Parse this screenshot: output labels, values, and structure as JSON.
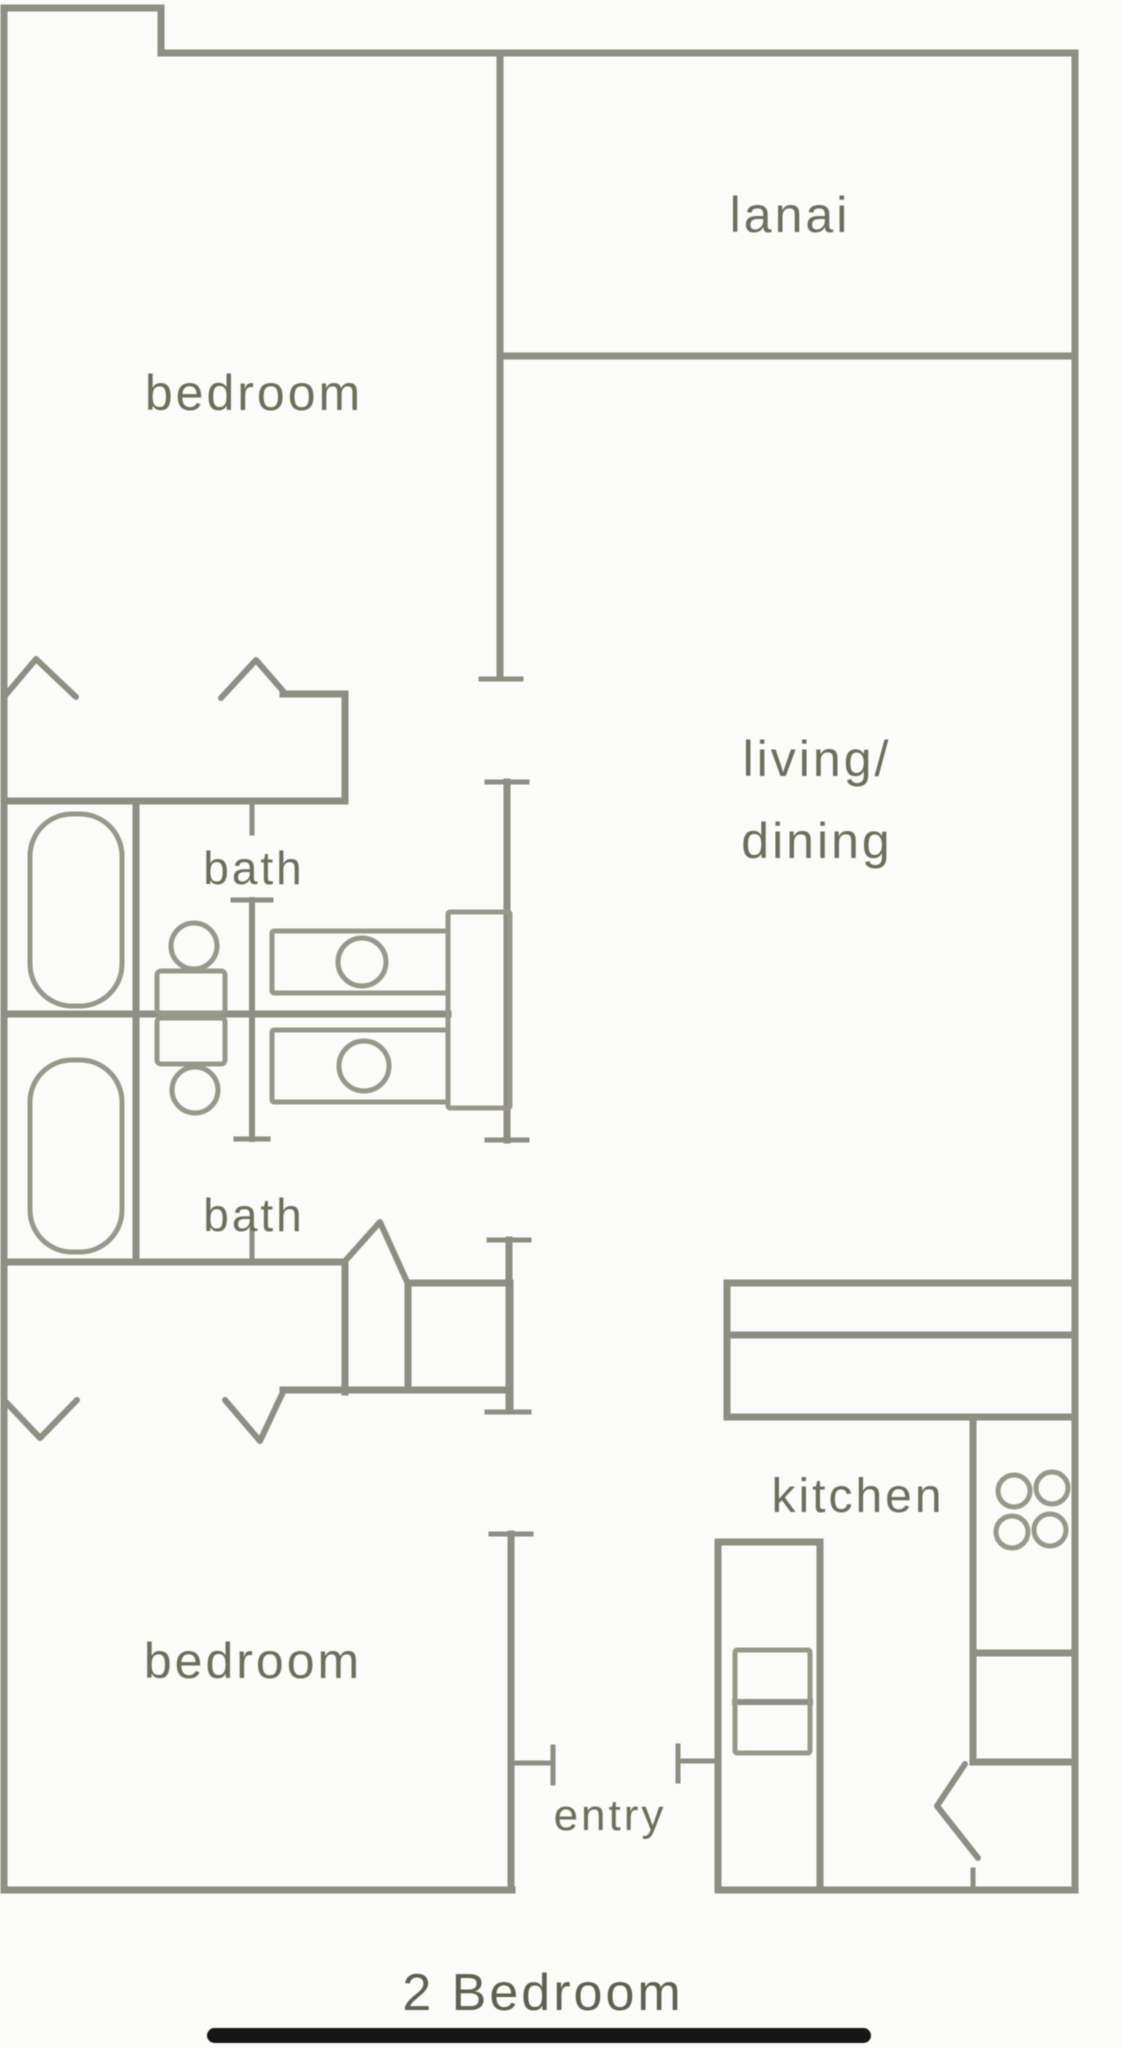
{
  "title": "2 Bedroom",
  "floorplan": {
    "canvas": {
      "width": 1122,
      "height": 2048
    },
    "colors": {
      "background": "#fbfbf9",
      "wall": "#8e8e82",
      "fixture": "#98988a",
      "label": "#6e6e5b",
      "title": "#60604f",
      "underline": "#161616"
    },
    "room_labels": [
      {
        "name": "label-lanai",
        "lines": [
          "lanai"
        ],
        "x": 790,
        "y": 232,
        "fontSize": 50
      },
      {
        "name": "label-bedroom-1",
        "lines": [
          "bedroom"
        ],
        "x": 254,
        "y": 410,
        "fontSize": 50
      },
      {
        "name": "label-living-dining",
        "lines": [
          "living/",
          "dining"
        ],
        "x": 817,
        "y": 776,
        "fontSize": 50,
        "lineHeight": 82
      },
      {
        "name": "label-bath-1",
        "lines": [
          "bath"
        ],
        "x": 254,
        "y": 884,
        "fontSize": 46
      },
      {
        "name": "label-bath-2",
        "lines": [
          "bath"
        ],
        "x": 254,
        "y": 1231,
        "fontSize": 46
      },
      {
        "name": "label-kitchen",
        "lines": [
          "kitchen"
        ],
        "x": 858,
        "y": 1512,
        "fontSize": 48
      },
      {
        "name": "label-entry",
        "lines": [
          "entry"
        ],
        "x": 610,
        "y": 1830,
        "fontSize": 44
      },
      {
        "name": "label-bedroom-2",
        "lines": [
          "bedroom"
        ],
        "x": 253,
        "y": 1678,
        "fontSize": 50
      }
    ],
    "plan_title": {
      "name": "plan-title",
      "text": "2 Bedroom",
      "x": 543,
      "y": 2010,
      "fontSize": 52
    },
    "title_underline": {
      "name": "title-underline-bar",
      "x": 207,
      "y": 2028,
      "w": 664,
      "h": 15
    },
    "walls": [
      {
        "name": "outer-top-left-upper",
        "x1": 4,
        "y1": 8,
        "x2": 161,
        "y2": 8
      },
      {
        "name": "outer-top-step",
        "x1": 161,
        "y1": 8,
        "x2": 161,
        "y2": 53
      },
      {
        "name": "outer-top-main",
        "x1": 161,
        "y1": 53,
        "x2": 1075,
        "y2": 53
      },
      {
        "name": "outer-right",
        "x1": 1075,
        "y1": 53,
        "x2": 1075,
        "y2": 1890
      },
      {
        "name": "outer-left",
        "x1": 4,
        "y1": 8,
        "x2": 4,
        "y2": 1890
      },
      {
        "name": "outer-bottom-left",
        "x1": 4,
        "y1": 1890,
        "x2": 512,
        "y2": 1890
      },
      {
        "name": "outer-bottom-right",
        "x1": 718,
        "y1": 1890,
        "x2": 1075,
        "y2": 1890
      },
      {
        "name": "bedroom1-living-divider",
        "x1": 500,
        "y1": 53,
        "x2": 500,
        "y2": 678
      },
      {
        "name": "divider-end-cap",
        "x1": 481,
        "y1": 679,
        "x2": 521,
        "y2": 679,
        "w": 5
      },
      {
        "name": "lanai-bottom-wall",
        "x1": 500,
        "y1": 356,
        "x2": 1075,
        "y2": 356
      },
      {
        "name": "hall-wall-cap-top",
        "x1": 487,
        "y1": 782,
        "x2": 527,
        "y2": 782,
        "w": 5
      },
      {
        "name": "hall-wall-upper",
        "x1": 507,
        "y1": 782,
        "x2": 507,
        "y2": 1140
      },
      {
        "name": "hall-wall-cap-mid",
        "x1": 487,
        "y1": 1140,
        "x2": 527,
        "y2": 1140,
        "w": 5
      },
      {
        "name": "hall-wall-cap-mid2",
        "x1": 489,
        "y1": 1240,
        "x2": 529,
        "y2": 1240,
        "w": 5
      },
      {
        "name": "hall-wall-lower",
        "x1": 509,
        "y1": 1240,
        "x2": 509,
        "y2": 1410
      },
      {
        "name": "hall-wall-cap-low",
        "x1": 487,
        "y1": 1412,
        "x2": 529,
        "y2": 1412,
        "w": 5
      },
      {
        "name": "bedroom2-door-cap",
        "x1": 491,
        "y1": 1534,
        "x2": 531,
        "y2": 1534,
        "w": 5
      },
      {
        "name": "entry-left-wall",
        "x1": 511,
        "y1": 1534,
        "x2": 511,
        "y2": 1890
      },
      {
        "name": "bed1-closet-step",
        "x1": 283,
        "y1": 694,
        "x2": 345,
        "y2": 694
      },
      {
        "name": "bed1-closet-side",
        "x1": 345,
        "y1": 694,
        "x2": 345,
        "y2": 801
      },
      {
        "name": "bath1-top-wall",
        "x1": 4,
        "y1": 801,
        "x2": 345,
        "y2": 801
      },
      {
        "name": "bath1-door-jamb",
        "x1": 252,
        "y1": 801,
        "x2": 252,
        "y2": 833,
        "w": 5
      },
      {
        "name": "tub-compartment-wall",
        "x1": 136,
        "y1": 801,
        "x2": 136,
        "y2": 1262
      },
      {
        "name": "baths-divider-wall",
        "x1": 4,
        "y1": 1014,
        "x2": 448,
        "y2": 1014
      },
      {
        "name": "bath-partition-cap-top",
        "x1": 233,
        "y1": 900,
        "x2": 271,
        "y2": 900,
        "w": 5
      },
      {
        "name": "bath-partition",
        "x1": 252,
        "y1": 900,
        "x2": 252,
        "y2": 1139,
        "w": 6
      },
      {
        "name": "bath-partition-cap-bot",
        "x1": 236,
        "y1": 1139,
        "x2": 268,
        "y2": 1139,
        "w": 5
      },
      {
        "name": "bath2-bottom-wall",
        "x1": 4,
        "y1": 1262,
        "x2": 345,
        "y2": 1262
      },
      {
        "name": "bath2-door-jamb",
        "x1": 252,
        "y1": 1230,
        "x2": 252,
        "y2": 1262,
        "w": 5
      },
      {
        "name": "bed2-closet-side",
        "x1": 345,
        "y1": 1262,
        "x2": 345,
        "y2": 1392
      },
      {
        "name": "bed2-closet-bottom",
        "x1": 283,
        "y1": 1390,
        "x2": 510,
        "y2": 1390
      },
      {
        "name": "bed2-closet-box-left",
        "x1": 408,
        "y1": 1283,
        "x2": 408,
        "y2": 1390
      },
      {
        "name": "bed2-closet-box-top",
        "x1": 408,
        "y1": 1283,
        "x2": 510,
        "y2": 1283
      },
      {
        "name": "bed2-closet-box-right",
        "x1": 510,
        "y1": 1283,
        "x2": 510,
        "y2": 1410
      },
      {
        "name": "entry-jamb-left",
        "x1": 512,
        "y1": 1763,
        "x2": 553,
        "y2": 1763,
        "w": 5
      },
      {
        "name": "entry-jamb-left-tick",
        "x1": 553,
        "y1": 1747,
        "x2": 553,
        "y2": 1783,
        "w": 5
      },
      {
        "name": "entry-jamb-right",
        "x1": 678,
        "y1": 1761,
        "x2": 718,
        "y2": 1761,
        "w": 5
      },
      {
        "name": "entry-jamb-right-tick",
        "x1": 678,
        "y1": 1746,
        "x2": 678,
        "y2": 1781,
        "w": 5
      },
      {
        "name": "counter-left-edge",
        "x1": 727,
        "y1": 1283,
        "x2": 727,
        "y2": 1417
      },
      {
        "name": "counter-top-line",
        "x1": 727,
        "y1": 1283,
        "x2": 1075,
        "y2": 1283
      },
      {
        "name": "counter-mid-line",
        "x1": 727,
        "y1": 1335,
        "x2": 1075,
        "y2": 1335
      },
      {
        "name": "counter-bottom-line",
        "x1": 727,
        "y1": 1417,
        "x2": 1075,
        "y2": 1417
      },
      {
        "name": "kitchen-interior-wall",
        "x1": 973,
        "y1": 1417,
        "x2": 973,
        "y2": 1762
      },
      {
        "name": "kitchen-counter-divider",
        "x1": 973,
        "y1": 1653,
        "x2": 1075,
        "y2": 1653
      },
      {
        "name": "kitchen-closet-top",
        "x1": 973,
        "y1": 1762,
        "x2": 1075,
        "y2": 1762
      },
      {
        "name": "kitchen-closet-jamb",
        "x1": 973,
        "y1": 1870,
        "x2": 973,
        "y2": 1890,
        "w": 5
      },
      {
        "name": "fridge-column-left",
        "x1": 718,
        "y1": 1542,
        "x2": 718,
        "y2": 1890
      },
      {
        "name": "fridge-column-right",
        "x1": 820,
        "y1": 1542,
        "x2": 820,
        "y2": 1890
      },
      {
        "name": "fridge-column-top",
        "x1": 718,
        "y1": 1542,
        "x2": 820,
        "y2": 1542
      },
      {
        "name": "fridge-inner-divider",
        "x1": 735,
        "y1": 1702,
        "x2": 810,
        "y2": 1702,
        "w": 6
      }
    ],
    "polylines": [
      {
        "name": "bed1-closet-door-left",
        "points": "4,697 36,659 76,697"
      },
      {
        "name": "bed1-closet-door-right",
        "points": "221,698 256,660 283,691"
      },
      {
        "name": "bath2-door-swing",
        "points": "346,1260 380,1222 408,1284"
      },
      {
        "name": "bed2-closet-door-left",
        "points": "4,1400 40,1438 77,1400"
      },
      {
        "name": "bed2-closet-door-right",
        "points": "225,1400 260,1441 283,1392"
      },
      {
        "name": "kitchen-closet-door",
        "points": "965,1764 937,1806 978,1858"
      }
    ],
    "fixtures": {
      "rects": [
        {
          "name": "bathtub-1",
          "x": 30,
          "y": 814,
          "w": 92,
          "h": 192,
          "rx": 42
        },
        {
          "name": "bathtub-2",
          "x": 30,
          "y": 1060,
          "w": 92,
          "h": 192,
          "rx": 42
        },
        {
          "name": "toilet-tank-1",
          "x": 157,
          "y": 971,
          "w": 68,
          "h": 42,
          "rx": 4
        },
        {
          "name": "toilet-tank-2",
          "x": 157,
          "y": 1018,
          "w": 68,
          "h": 46,
          "rx": 4
        },
        {
          "name": "vanity-counter",
          "x": 448,
          "y": 912,
          "w": 62,
          "h": 196,
          "rx": 2
        },
        {
          "name": "sink-counter-1",
          "x": 272,
          "y": 931,
          "w": 176,
          "h": 62,
          "rx": 2
        },
        {
          "name": "sink-counter-2",
          "x": 272,
          "y": 1030,
          "w": 176,
          "h": 72,
          "rx": 2
        },
        {
          "name": "fridge-inner-box",
          "x": 735,
          "y": 1650,
          "w": 75,
          "h": 103,
          "rx": 2
        }
      ],
      "circles": [
        {
          "name": "toilet-bowl-1",
          "cx": 194,
          "cy": 946,
          "r": 23
        },
        {
          "name": "toilet-bowl-2",
          "cx": 195,
          "cy": 1090,
          "r": 23
        },
        {
          "name": "sink-basin-1",
          "cx": 362,
          "cy": 962,
          "r": 24
        },
        {
          "name": "sink-basin-2",
          "cx": 364,
          "cy": 1066,
          "r": 25
        },
        {
          "name": "stove-burner-1",
          "cx": 1014,
          "cy": 1491,
          "r": 16
        },
        {
          "name": "stove-burner-2",
          "cx": 1052,
          "cy": 1488,
          "r": 16
        },
        {
          "name": "stove-burner-3",
          "cx": 1012,
          "cy": 1532,
          "r": 16
        },
        {
          "name": "stove-burner-4",
          "cx": 1050,
          "cy": 1530,
          "r": 16
        }
      ]
    }
  }
}
